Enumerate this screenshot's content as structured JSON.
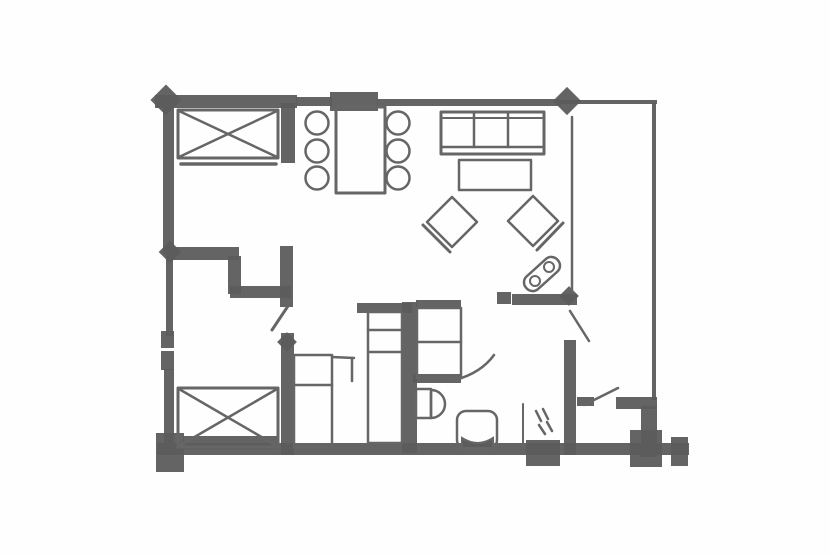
{
  "canvas": {
    "width": 830,
    "height": 555,
    "background": "#fefefe",
    "ink": "#5c5c5c",
    "ink_soft": "#666666"
  },
  "floorplan": {
    "description": "hand-drawn apartment floor plan sketch, dark gray ink on white",
    "walls": [
      {
        "name": "top-wall-left",
        "x": 155,
        "y": 95,
        "w": 142,
        "h": 13
      },
      {
        "name": "top-wall-mid",
        "x": 296,
        "y": 97,
        "w": 36,
        "h": 9
      },
      {
        "name": "top-wall-block",
        "x": 330,
        "y": 92,
        "w": 48,
        "h": 19
      },
      {
        "name": "top-wall-right-mid",
        "x": 377,
        "y": 99,
        "w": 184,
        "h": 7
      },
      {
        "name": "top-wall-right-thin",
        "x": 560,
        "y": 100,
        "w": 97,
        "h": 4
      },
      {
        "name": "left-wall-upper",
        "x": 163,
        "y": 96,
        "w": 11,
        "h": 158
      },
      {
        "name": "left-wall-mid",
        "x": 166,
        "y": 254,
        "w": 7,
        "h": 82
      },
      {
        "name": "left-window-upper",
        "x": 161,
        "y": 331,
        "w": 13,
        "h": 17
      },
      {
        "name": "left-window-lower",
        "x": 161,
        "y": 351,
        "w": 13,
        "h": 19
      },
      {
        "name": "left-wall-lower",
        "x": 164,
        "y": 369,
        "w": 10,
        "h": 86
      },
      {
        "name": "bottom-wall",
        "x": 157,
        "y": 443,
        "w": 532,
        "h": 12
      },
      {
        "name": "bottom-left-post",
        "x": 156,
        "y": 433,
        "w": 28,
        "h": 39
      },
      {
        "name": "bottom-post-shower",
        "x": 526,
        "y": 440,
        "w": 34,
        "h": 26
      },
      {
        "name": "bottom-post-entry",
        "x": 630,
        "y": 430,
        "w": 32,
        "h": 37
      },
      {
        "name": "bottom-stub-right",
        "x": 671,
        "y": 437,
        "w": 17,
        "h": 29
      },
      {
        "name": "right-wall",
        "x": 652,
        "y": 103,
        "w": 4,
        "h": 297
      },
      {
        "name": "bed-nook-stub",
        "x": 281,
        "y": 103,
        "w": 14,
        "h": 60
      },
      {
        "name": "bedroom-wall-a",
        "x": 168,
        "y": 247,
        "w": 71,
        "h": 13
      },
      {
        "name": "bedroom-wall-step",
        "x": 228,
        "y": 256,
        "w": 13,
        "h": 38
      },
      {
        "name": "bedroom-wall-b",
        "x": 230,
        "y": 286,
        "w": 61,
        "h": 12
      },
      {
        "name": "bedroom-door-stub",
        "x": 280,
        "y": 246,
        "w": 13,
        "h": 61
      },
      {
        "name": "bedroom-wall-east",
        "x": 281,
        "y": 333,
        "w": 13,
        "h": 122
      },
      {
        "name": "kitchen-counter",
        "x": 357,
        "y": 303,
        "w": 55,
        "h": 10
      },
      {
        "name": "kitchen-wall",
        "x": 402,
        "y": 302,
        "w": 15,
        "h": 151
      },
      {
        "name": "bath-wall-over-vanity",
        "x": 416,
        "y": 300,
        "w": 45,
        "h": 9
      },
      {
        "name": "bath-wall-cap",
        "x": 497,
        "y": 292,
        "w": 14,
        "h": 12
      },
      {
        "name": "bath-wall-north",
        "x": 512,
        "y": 294,
        "w": 65,
        "h": 11
      },
      {
        "name": "corridor-wall-lower",
        "x": 564,
        "y": 340,
        "w": 12,
        "h": 115
      },
      {
        "name": "entry-door-stub",
        "x": 577,
        "y": 397,
        "w": 17,
        "h": 9
      },
      {
        "name": "entry-wall-horizontal",
        "x": 616,
        "y": 397,
        "w": 41,
        "h": 12
      },
      {
        "name": "entry-wall-vertical",
        "x": 641,
        "y": 406,
        "w": 16,
        "h": 51
      },
      {
        "name": "vanity-base-band",
        "x": 413,
        "y": 374,
        "w": 48,
        "h": 9
      },
      {
        "name": "bed2-base-band",
        "x": 183,
        "y": 436,
        "w": 95,
        "h": 13
      }
    ],
    "nodes": [
      {
        "name": "post-top-left",
        "cx": 166,
        "cy": 100,
        "s": 22
      },
      {
        "name": "post-top-right-mid",
        "cx": 567,
        "cy": 101,
        "s": 20
      },
      {
        "name": "node-left-wall",
        "cx": 170,
        "cy": 252,
        "s": 16
      },
      {
        "name": "node-bedroom-east",
        "cx": 287,
        "cy": 342,
        "s": 14
      },
      {
        "name": "node-bath-corner",
        "cx": 569,
        "cy": 296,
        "s": 14
      }
    ],
    "strokes": [
      {
        "name": "corridor-wall-thin",
        "x1": 572,
        "y1": 117,
        "x2": 572,
        "y2": 293,
        "w": 2.5
      },
      {
        "name": "bedroom-door-leaf",
        "x1": 288,
        "y1": 306,
        "x2": 272,
        "y2": 330,
        "w": 3
      },
      {
        "name": "corridor-door-leaf",
        "x1": 570,
        "y1": 311,
        "x2": 589,
        "y2": 341,
        "w": 2.5
      },
      {
        "name": "entry-door-leaf",
        "x1": 584,
        "y1": 405,
        "x2": 618,
        "y2": 388,
        "w": 2.5
      },
      {
        "name": "closet-ext-top",
        "x1": 332,
        "y1": 357,
        "x2": 354,
        "y2": 358,
        "w": 2.5
      },
      {
        "name": "closet-ext-side",
        "x1": 352,
        "y1": 358,
        "x2": 352,
        "y2": 381,
        "w": 2.5
      },
      {
        "name": "shower-screen",
        "x1": 523,
        "y1": 404,
        "x2": 523,
        "y2": 447,
        "w": 2
      },
      {
        "name": "shower-dash-1",
        "x1": 536,
        "y1": 411,
        "x2": 541,
        "y2": 421,
        "w": 2.5
      },
      {
        "name": "shower-dash-2",
        "x1": 543,
        "y1": 409,
        "x2": 548,
        "y2": 419,
        "w": 2.5
      },
      {
        "name": "shower-dash-3",
        "x1": 539,
        "y1": 425,
        "x2": 545,
        "y2": 434,
        "w": 2.5
      },
      {
        "name": "shower-dash-4",
        "x1": 547,
        "y1": 422,
        "x2": 552,
        "y2": 431,
        "w": 2.5
      },
      {
        "name": "bed1-foot-rail",
        "x1": 181,
        "y1": 164,
        "x2": 276,
        "y2": 164,
        "w": 3.5
      },
      {
        "name": "bed1-cross-a",
        "x1": 179,
        "y1": 111,
        "x2": 277,
        "y2": 157,
        "w": 2.5
      },
      {
        "name": "bed1-cross-b",
        "x1": 277,
        "y1": 111,
        "x2": 179,
        "y2": 157,
        "w": 2.5
      },
      {
        "name": "bed2-cross-a",
        "x1": 179,
        "y1": 389,
        "x2": 277,
        "y2": 446,
        "w": 2.5
      },
      {
        "name": "bed2-cross-b",
        "x1": 277,
        "y1": 389,
        "x2": 179,
        "y2": 446,
        "w": 2.5
      },
      {
        "name": "sofa-back-line",
        "x1": 443,
        "y1": 118,
        "x2": 542,
        "y2": 118,
        "w": 2
      },
      {
        "name": "sofa-seat-edge",
        "x1": 441,
        "y1": 147,
        "x2": 544,
        "y2": 147,
        "w": 2.5
      },
      {
        "name": "sofa-divider-1",
        "x1": 474,
        "y1": 113,
        "x2": 474,
        "y2": 147,
        "w": 2.5
      },
      {
        "name": "sofa-divider-2",
        "x1": 508,
        "y1": 113,
        "x2": 508,
        "y2": 147,
        "w": 2.5
      },
      {
        "name": "closet1-shelf",
        "x1": 294,
        "y1": 385,
        "x2": 332,
        "y2": 385,
        "w": 2.5
      },
      {
        "name": "closet2-shelf-1",
        "x1": 368,
        "y1": 330,
        "x2": 402,
        "y2": 330,
        "w": 2.5
      },
      {
        "name": "closet2-shelf-2",
        "x1": 368,
        "y1": 352,
        "x2": 402,
        "y2": 352,
        "w": 2.5
      },
      {
        "name": "vanity-shelf",
        "x1": 417,
        "y1": 342,
        "x2": 461,
        "y2": 342,
        "w": 2.5
      },
      {
        "name": "toilet-tank-join",
        "x1": 431,
        "y1": 392,
        "x2": 431,
        "y2": 416,
        "w": 2.5
      },
      {
        "name": "armchair-left-back",
        "x1": 450,
        "y1": 252,
        "x2": 423,
        "y2": 225,
        "w": 3
      },
      {
        "name": "armchair-right-back",
        "x1": 537,
        "y1": 250,
        "x2": 563,
        "y2": 223,
        "w": 3
      }
    ],
    "rects": [
      {
        "name": "bed1",
        "x": 178,
        "y": 110,
        "w": 100,
        "h": 48,
        "sw": 3
      },
      {
        "name": "bed2",
        "x": 178,
        "y": 388,
        "w": 100,
        "h": 59,
        "sw": 3
      },
      {
        "name": "dining-table",
        "x": 336,
        "y": 107,
        "w": 49,
        "h": 86,
        "sw": 3
      },
      {
        "name": "sofa",
        "x": 441,
        "y": 112,
        "w": 103,
        "h": 42,
        "sw": 3
      },
      {
        "name": "coffee-table",
        "x": 459,
        "y": 160,
        "w": 72,
        "h": 30,
        "sw": 2.5
      },
      {
        "name": "closet1-bedroom",
        "x": 294,
        "y": 355,
        "w": 38,
        "h": 92,
        "sw": 2.5
      },
      {
        "name": "closet2-kitchen",
        "x": 368,
        "y": 312,
        "w": 34,
        "h": 131,
        "sw": 2.5
      },
      {
        "name": "bath-vanity",
        "x": 417,
        "y": 308,
        "w": 44,
        "h": 70,
        "sw": 2.5
      },
      {
        "name": "toilet-tank",
        "x": 416,
        "y": 389,
        "w": 15,
        "h": 29,
        "sw": 2.5
      },
      {
        "name": "wash-basin",
        "x": 457,
        "y": 411,
        "w": 40,
        "h": 38,
        "sw": 2.5,
        "rx": 9
      }
    ],
    "rot_rects": [
      {
        "name": "ottoman-capsule",
        "cx": 542,
        "cy": 274,
        "w": 42,
        "h": 17,
        "angle": -42,
        "rx": 8,
        "sw": 2.5
      }
    ],
    "circles": [
      {
        "name": "dining-chair-1",
        "cx": 317,
        "cy": 123,
        "r": 11.5,
        "sw": 2.5
      },
      {
        "name": "dining-chair-2",
        "cx": 317,
        "cy": 151,
        "r": 11.5,
        "sw": 2.5
      },
      {
        "name": "dining-chair-3",
        "cx": 317,
        "cy": 178,
        "r": 11.5,
        "sw": 2.5
      },
      {
        "name": "dining-chair-4",
        "cx": 398,
        "cy": 123,
        "r": 11.5,
        "sw": 2.5
      },
      {
        "name": "dining-chair-5",
        "cx": 398,
        "cy": 151,
        "r": 11.5,
        "sw": 2.5
      },
      {
        "name": "dining-chair-6",
        "cx": 398,
        "cy": 178,
        "r": 11.5,
        "sw": 2.5
      },
      {
        "name": "capsule-knob-1",
        "cx": 535,
        "cy": 281,
        "r": 5,
        "sw": 2
      },
      {
        "name": "capsule-knob-2",
        "cx": 549,
        "cy": 267,
        "r": 5,
        "sw": 2
      }
    ],
    "polygons": [
      {
        "name": "armchair-left",
        "points": "452,197 477,222 452,247 427,222",
        "sw": 2.5
      },
      {
        "name": "armchair-right",
        "points": "533,196 558,221 533,246 508,221",
        "sw": 2.5
      }
    ],
    "paths": [
      {
        "name": "toilet-bowl",
        "d": "M 431 390 a 14 14 0 1 1 0 28",
        "sw": 2.5
      },
      {
        "name": "bath-door-arc",
        "d": "M 455 380 Q 481 373 494 355",
        "sw": 2.5
      },
      {
        "name": "basin-base-band",
        "d": "M 462 438 q 16 10 31 0 l 0 10 l -31 0 z",
        "sw": 2,
        "fill": true
      }
    ]
  }
}
